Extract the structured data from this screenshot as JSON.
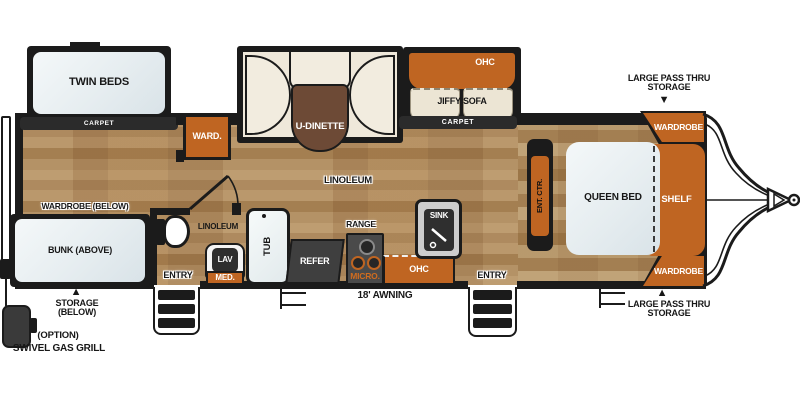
{
  "title": "Travel trailer floor plan",
  "colors": {
    "accent_orange": "#bf6522",
    "wall_black": "#1b1b1b",
    "carpet_strip": "#2b2b2b",
    "wood_floor_tan": "#d8c3a4",
    "bedroom_carpet_tan": "#d3bd9c",
    "bed_white": "#eaf0f2",
    "dinette_cushion_cream": "#efe8da",
    "table_brown": "#6d4a36",
    "refer_gray": "#3f3f3f"
  },
  "labels": {
    "twin_beds": "TWIN BEDS",
    "carpet": "CARPET",
    "ward": "WARD.",
    "u_dinette": "U-DINETTE",
    "ohc": "OHC",
    "jiffy_sofa": "JIFFY SOFA",
    "pass_thru": "LARGE PASS THRU STORAGE",
    "wardrobe": "WARDROBE",
    "queen_bed": "QUEEN BED",
    "shelf": "SHELF",
    "ent_ctr": "ENT. CTR.",
    "linoleum": "LINOLEUM",
    "wardrobe_below": "WARDROBE (BELOW)",
    "bunk_above": "BUNK (ABOVE)",
    "entry": "ENTRY",
    "storage_below": "STORAGE (BELOW)",
    "option": "(OPTION)",
    "swivel_gas_grill": "SWIVEL GAS GRILL",
    "range": "RANGE",
    "refer": "REFER",
    "micro": "MICRO.",
    "sink": "SINK",
    "tub": "TUB",
    "lav": "LAV",
    "med": "MED.",
    "awning": "18' AWNING"
  },
  "icons": {
    "arrow_up": "▲",
    "arrow_down": "▼"
  }
}
